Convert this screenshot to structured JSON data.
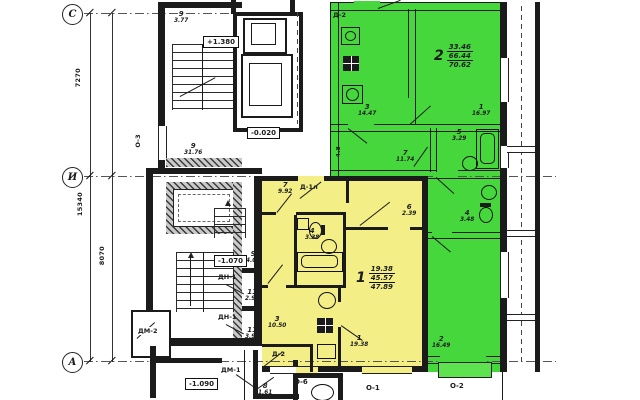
{
  "plan": {
    "axis_rows": {
      "c": "С",
      "i": "И",
      "a": "А"
    },
    "axis_cols": {
      "o3": "О-3",
      "o6": "О-6",
      "o1": "О-1",
      "o2": "О-2"
    },
    "dims": {
      "total": "15340",
      "upper": "7270",
      "lower": "8070"
    },
    "elevations": {
      "up": "+1.380",
      "zero": "-0.020",
      "low1": "-1.070",
      "low2": "-1.090"
    },
    "doors": {
      "d2_top": "Д-2",
      "d1l": "Д-1л",
      "d2_entry": "Д-2",
      "dn1_a": "ДН-1",
      "dn1_b": "ДН-1",
      "dm1": "ДМ-1",
      "dm2": "ДМ-2"
    },
    "apartments": {
      "a1": {
        "num": "1",
        "living": "19.38",
        "usable": "45.57",
        "total": "47.89"
      },
      "a2": {
        "num": "2",
        "living": "33.46",
        "usable": "66.44",
        "total": "70.62"
      }
    },
    "rooms": {
      "stair_room": {
        "n": "9",
        "a": "3.77"
      },
      "corridor": {
        "n": "9",
        "a": "31.76"
      },
      "vestibule": {
        "n": "9",
        "a": "4.07"
      },
      "tambour_upper": {
        "n": "11",
        "a": "2.94"
      },
      "tambour_lower": {
        "n": "11",
        "a": "3.91"
      },
      "entry_room": {
        "n": "8",
        "a": "1.61"
      },
      "y_hall": {
        "n": "7",
        "a": "9.92"
      },
      "y_bath": {
        "n": "4",
        "a": "3.38"
      },
      "y_closet": {
        "n": "6",
        "a": "2.39"
      },
      "y_kitchen": {
        "n": "3",
        "a": "10.50"
      },
      "y_living": {
        "n": "1",
        "a": "19.38"
      },
      "g_kitchen": {
        "n": "3",
        "a": "14.47"
      },
      "g_hall": {
        "n": "7",
        "a": "11.74"
      },
      "g_bath": {
        "n": "5",
        "a": "3.29"
      },
      "g_wc": {
        "n": "4",
        "a": "3.48"
      },
      "g_room1": {
        "n": "1",
        "a": "16.97"
      },
      "g_room2": {
        "n": "2",
        "a": "16.49"
      },
      "g_small": {
        "a": "4.8"
      }
    },
    "colors": {
      "apartment1_fill": "#f3ee86",
      "apartment2_fill": "#46d73d",
      "wall": "#1b1b1b"
    }
  }
}
